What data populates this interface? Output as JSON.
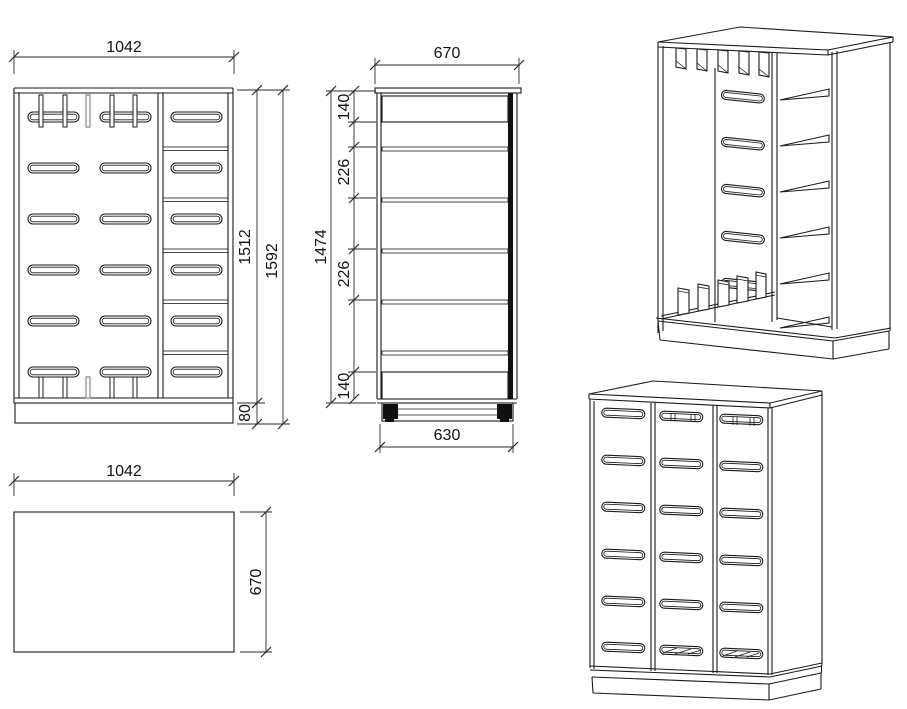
{
  "drawing": {
    "colors": {
      "background": "#ffffff",
      "line": "#1a1a1a",
      "muted_line": "#9a9a9a"
    },
    "views": {
      "front": {
        "dim_width": "1042",
        "dim_body_height": "1512",
        "dim_total_height": "1592",
        "dim_plinth_height": "80"
      },
      "side_section": {
        "dim_depth": "670",
        "dim_top_gap": "140",
        "dim_upper_shelf_gap": "226",
        "dim_lower_shelf_gap": "226",
        "dim_bottom_gap": "140",
        "dim_carcass_height": "1474",
        "dim_base_depth": "630"
      },
      "plan": {
        "dim_width": "1042",
        "dim_depth": "670"
      }
    }
  }
}
